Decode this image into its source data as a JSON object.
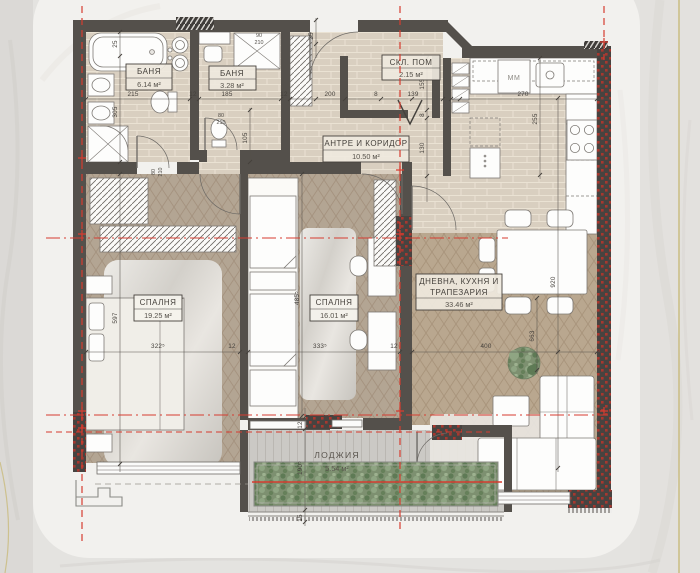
{
  "rooms": [
    {
      "name": "БАНЯ",
      "area": "6.14 м²"
    },
    {
      "name": "БАНЯ",
      "area": "3.28 м²"
    },
    {
      "name": "СКЛ. ПОМ",
      "area": "2.15 м²"
    },
    {
      "name": "АНТРЕ И КОРИДОР",
      "area": "10.50 м²"
    },
    {
      "name": "СПАЛНЯ",
      "area": "19.25 м²"
    },
    {
      "name": "СПАЛНЯ",
      "area": "16.01 м²"
    },
    {
      "name": "ДНЕВНА, КУХНЯ И",
      "name2": "ТРАПЕЗАРИЯ",
      "area": "33.46 м²"
    },
    {
      "name": "ЛОДЖИЯ",
      "area": "5.54 м²"
    }
  ],
  "labels": {
    "washing_machine": "MM"
  },
  "dims": [
    "215",
    "12",
    "185",
    "12",
    "200",
    "8",
    "139",
    "270",
    "25",
    "305",
    "105",
    "25",
    "155",
    "8",
    "130",
    "255",
    "597",
    "322⁵",
    "12",
    "333⁵",
    "12",
    "400",
    "485⁵",
    "920",
    "663",
    "12",
    "190⁵",
    "15",
    "80",
    "210",
    "80",
    "210",
    "90",
    "210"
  ],
  "palette": {
    "wall": "#54504b",
    "axis_red": "#d63c30",
    "gold_accent": "#c9ba7c",
    "tile_floor": "#d9cfc0",
    "wood_floor": "#b4a695",
    "deck_floor": "#cbc9c5",
    "planter_green": "#7d9070",
    "marble_background": "#e7e6e3",
    "card": "#f2f1ee"
  }
}
